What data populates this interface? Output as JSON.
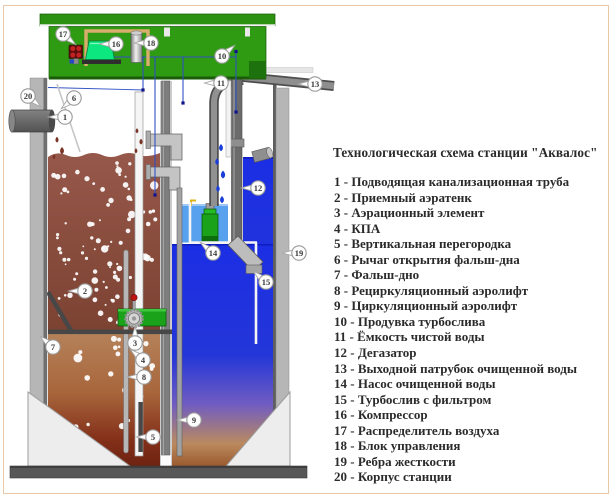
{
  "figure": {
    "title": "Технологическая схема станции \"Аквалос\""
  },
  "legend": {
    "items": [
      {
        "n": "1",
        "label": "Подводящая канализационная труба"
      },
      {
        "n": "2",
        "label": "Приемный аэратенк"
      },
      {
        "n": "3",
        "label": "Аэрационный элемент"
      },
      {
        "n": "4",
        "label": "КПА"
      },
      {
        "n": "5",
        "label": "Вертикальная перегородка"
      },
      {
        "n": "6",
        "label": "Рычаг открытия фальш-дна"
      },
      {
        "n": "7",
        "label": "Фальш-дно"
      },
      {
        "n": "8",
        "label": "Рециркуляционный аэролифт"
      },
      {
        "n": "9",
        "label": "Циркуляционный аэролифт"
      },
      {
        "n": "10",
        "label": "Продувка турбослива"
      },
      {
        "n": "11",
        "label": "Ёмкость чистой воды"
      },
      {
        "n": "12",
        "label": "Дегазатор"
      },
      {
        "n": "13",
        "label": "Выходной патрубок очищенной воды"
      },
      {
        "n": "14",
        "label": "Насос очищенной воды"
      },
      {
        "n": "15",
        "label": "Турбослив с фильтром"
      },
      {
        "n": "16",
        "label": "Компрессор"
      },
      {
        "n": "17",
        "label": "Распределитель воздуха"
      },
      {
        "n": "18",
        "label": "Блок управления"
      },
      {
        "n": "19",
        "label": "Ребра жесткости"
      },
      {
        "n": "20",
        "label": "Корпус станции"
      }
    ]
  },
  "callouts": [
    {
      "n": "1",
      "x": 65,
      "y": 117,
      "dir": "l"
    },
    {
      "n": "2",
      "x": 85,
      "y": 291,
      "dir": "l"
    },
    {
      "n": "3",
      "x": 135,
      "y": 343,
      "dir": "u"
    },
    {
      "n": "4",
      "x": 143,
      "y": 360,
      "dir": "ul"
    },
    {
      "n": "5",
      "x": 153,
      "y": 437,
      "dir": "l"
    },
    {
      "n": "6",
      "x": 74,
      "y": 98,
      "dir": "dl"
    },
    {
      "n": "7",
      "x": 53,
      "y": 347,
      "dir": "ul"
    },
    {
      "n": "8",
      "x": 144,
      "y": 377,
      "dir": "l"
    },
    {
      "n": "9",
      "x": 194,
      "y": 420,
      "dir": "l"
    },
    {
      "n": "10",
      "x": 222,
      "y": 56,
      "dir": "ur"
    },
    {
      "n": "11",
      "x": 221,
      "y": 83,
      "dir": "l"
    },
    {
      "n": "12",
      "x": 258,
      "y": 188,
      "dir": "l"
    },
    {
      "n": "13",
      "x": 315,
      "y": 84,
      "dir": "l"
    },
    {
      "n": "14",
      "x": 213,
      "y": 253,
      "dir": "ul"
    },
    {
      "n": "15",
      "x": 266,
      "y": 282,
      "dir": "ul"
    },
    {
      "n": "16",
      "x": 116,
      "y": 44,
      "dir": "l"
    },
    {
      "n": "17",
      "x": 63,
      "y": 34,
      "dir": "dr"
    },
    {
      "n": "18",
      "x": 151,
      "y": 43,
      "dir": "l"
    },
    {
      "n": "19",
      "x": 299,
      "y": 253,
      "dir": "l"
    },
    {
      "n": "20",
      "x": 28,
      "y": 96,
      "dir": "dr"
    }
  ],
  "colors": {
    "lid_green": "#2f9b13",
    "compressor_green": "#0ce87f",
    "clean_water_blue": "#1c2ee4",
    "light_pool_blue": "#57a1ee",
    "sludge_brown": "#8d5040",
    "station_gray": "#b6b6b6",
    "frame_tan": "#d9ad6d",
    "distributor_red": "#c32222",
    "text_color": "#2b2b2b",
    "page_border": "#e9c7a7"
  }
}
